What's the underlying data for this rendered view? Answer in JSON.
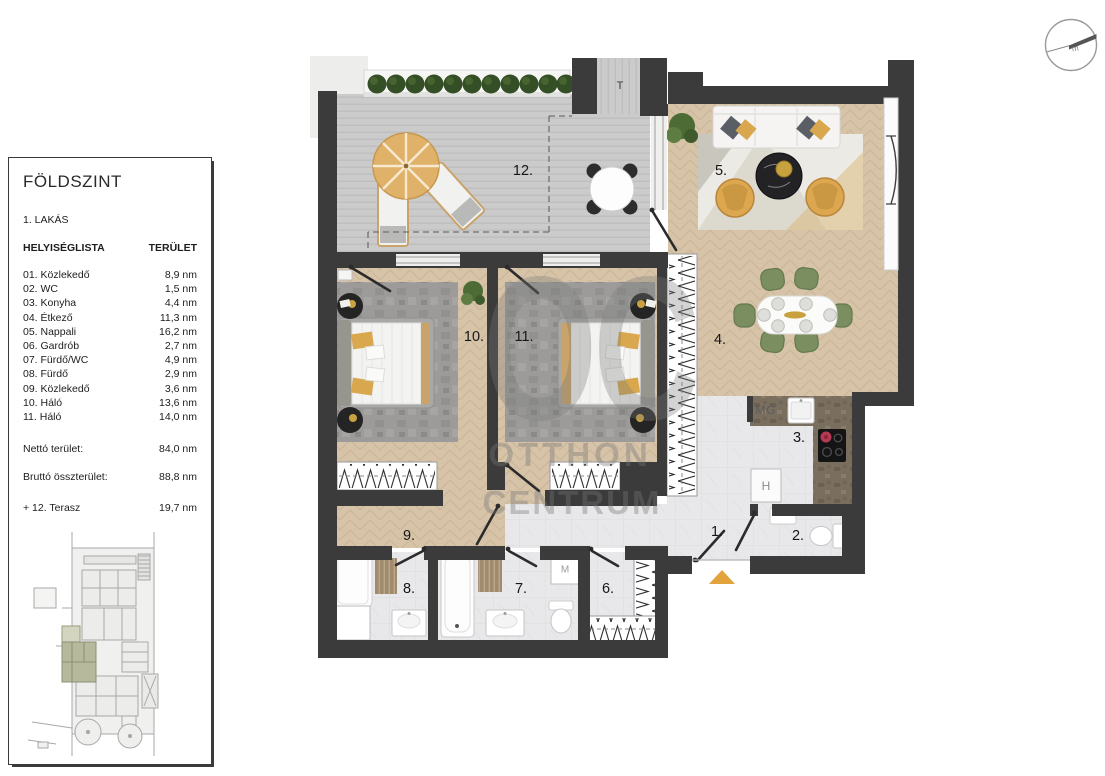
{
  "panel": {
    "title": "FÖLDSZINT",
    "unit": "1. LAKÁS",
    "columns": {
      "name": "HELYISÉGLISTA",
      "area": "TERÜLET"
    },
    "rooms": [
      {
        "label": "01. Közlekedő",
        "area": "8,9 nm"
      },
      {
        "label": "02. WC",
        "area": "1,5 nm"
      },
      {
        "label": "03. Konyha",
        "area": "4,4 nm"
      },
      {
        "label": "04. Étkező",
        "area": "11,3 nm"
      },
      {
        "label": "05. Nappali",
        "area": "16,2 nm"
      },
      {
        "label": "06. Gardrób",
        "area": "2,7 nm"
      },
      {
        "label": "07. Fürdő/WC",
        "area": "4,9 nm"
      },
      {
        "label": "08. Fürdő",
        "area": "2,9 nm"
      },
      {
        "label": "09. Közlekedő",
        "area": "3,6 nm"
      },
      {
        "label": "10. Háló",
        "area": "13,6 nm"
      },
      {
        "label": "11. Háló",
        "area": "14,0 nm"
      }
    ],
    "totals": [
      {
        "label": "Nettó terület:",
        "area": "84,0 nm"
      },
      {
        "label": "Bruttó összterület:",
        "area": "88,8 nm"
      },
      {
        "label": "+ 12. Terasz",
        "area": "19,7 nm"
      }
    ]
  },
  "plan": {
    "labels": {
      "hall1": "1.",
      "wc2": "2.",
      "kitchen3": "3.",
      "dining4": "4.",
      "living5": "5.",
      "gardrobe6": "6.",
      "bath7": "7.",
      "bath8": "8.",
      "corridor9": "9.",
      "bedroom10": "10.",
      "bedroom11": "11.",
      "terrace12": "12."
    },
    "tags": {
      "storage": "T",
      "dishwasher": "MG",
      "fridge": "H",
      "washer": "M"
    },
    "watermark": {
      "initials": "OC",
      "line1": "OTTHON",
      "line2": "CENTRUM"
    },
    "compass_label": "m"
  },
  "colors": {
    "wall": "#3b3b3b",
    "wood": "#d6c3a8",
    "deck": "#cacaca",
    "marble": "#e8e8ea",
    "counter": "#7a6e5f",
    "mustard": "#d9a84e",
    "chair_green": "#7a8e60",
    "entrance_marker": "#e2a33c",
    "bush": "#344e25",
    "site_highlight": "#b7b99c"
  }
}
